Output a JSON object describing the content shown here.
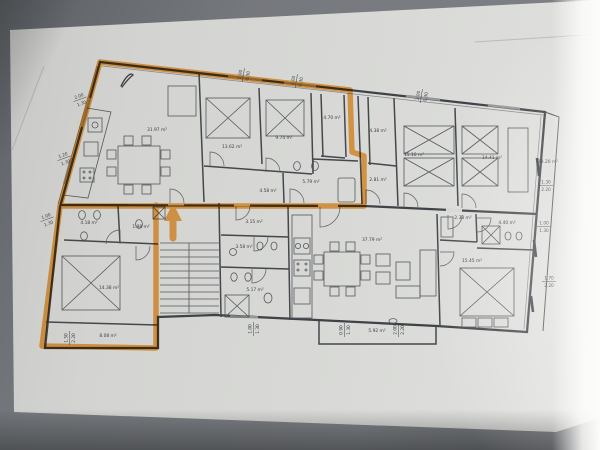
{
  "rooms": {
    "living_top": "31.97 m²",
    "bedroom_a": "13.62 m²",
    "bedroom_b": "9.74 m²",
    "room_470": "4.70 m²",
    "room_438": "4.38 m²",
    "room_281": "2.81 m²",
    "bath_579": "5.79 m²",
    "hall_458": "4.58 m²",
    "bedroom_r1": "15.16 m²",
    "bedroom_r2": "14.41 m²",
    "terrace_right": "13.20 m²",
    "vestibule": "3.15 m²",
    "wc_358": "3.58 m²",
    "bath_517": "5.17 m²",
    "bath_418": "4.18 m²",
    "wc_198": "1.98 m²",
    "bedroom_left": "14.38 m²",
    "balcony_left": "8.08 m²",
    "living_main": "37.79 m²",
    "closet_238": "2.38 m²",
    "bath_440": "4.40 m²",
    "bedroom_br": "15.45 m²",
    "balcony_mid": "5.92 m²"
  },
  "dims": {
    "left": [
      [
        "2.00",
        "1.30"
      ],
      [
        "1.20",
        "1.30"
      ],
      [
        "1.00",
        "1.30"
      ]
    ],
    "top": [
      [
        "2.00",
        "0.30"
      ],
      [
        "2.00",
        "0.30"
      ],
      [
        "2.00",
        "0.30"
      ]
    ],
    "right": [
      [
        "1.30",
        "2.20"
      ],
      [
        "1.00",
        "1.30"
      ],
      [
        "1.70",
        "2.20"
      ]
    ],
    "bottom": [
      [
        "1.50",
        "2.20"
      ],
      [
        "1.00",
        "1.30"
      ],
      [
        "0.90",
        "1.30"
      ],
      [
        "2.00",
        "2.20"
      ]
    ]
  },
  "colors": {
    "highlighter": "#f5941f",
    "ink": "#3e4145",
    "paper": "#d4d5d2"
  }
}
